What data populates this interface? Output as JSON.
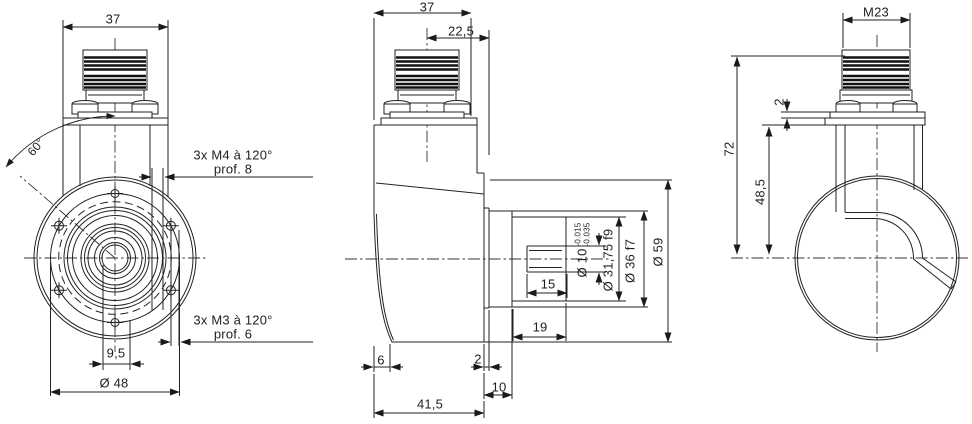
{
  "drawing": {
    "left_view": {
      "dim_width": "37",
      "dim_angle": "60°",
      "label_m4_line1": "3x M4 à 120°",
      "label_m4_line2": "prof. 8",
      "label_m3_line1": "3x M3 à 120°",
      "label_m3_line2": "prof. 6",
      "dim_hole_offset": "9,5",
      "dim_flange_dia": "Ø 48"
    },
    "middle_view": {
      "dim_width": "37",
      "dim_connector_offset": "22,5",
      "dim_bore": "Ø 10",
      "bore_tol_upper": "-0.015",
      "bore_tol_lower": "-0.035",
      "dim_spigot_dia": "Ø 31,75 f9",
      "dim_collar_dia": "Ø 36 f7",
      "dim_body_dia": "Ø 59",
      "dim_keyway_len": "15",
      "dim_spigot_len": "19",
      "dim_foot": "6",
      "dim_step": "2",
      "dim_flange_depth": "10",
      "dim_body_depth": "41,5"
    },
    "right_view": {
      "dim_thread": "M23",
      "dim_plate": "2",
      "dim_height_total": "72",
      "dim_height_flange": "48,5"
    }
  }
}
